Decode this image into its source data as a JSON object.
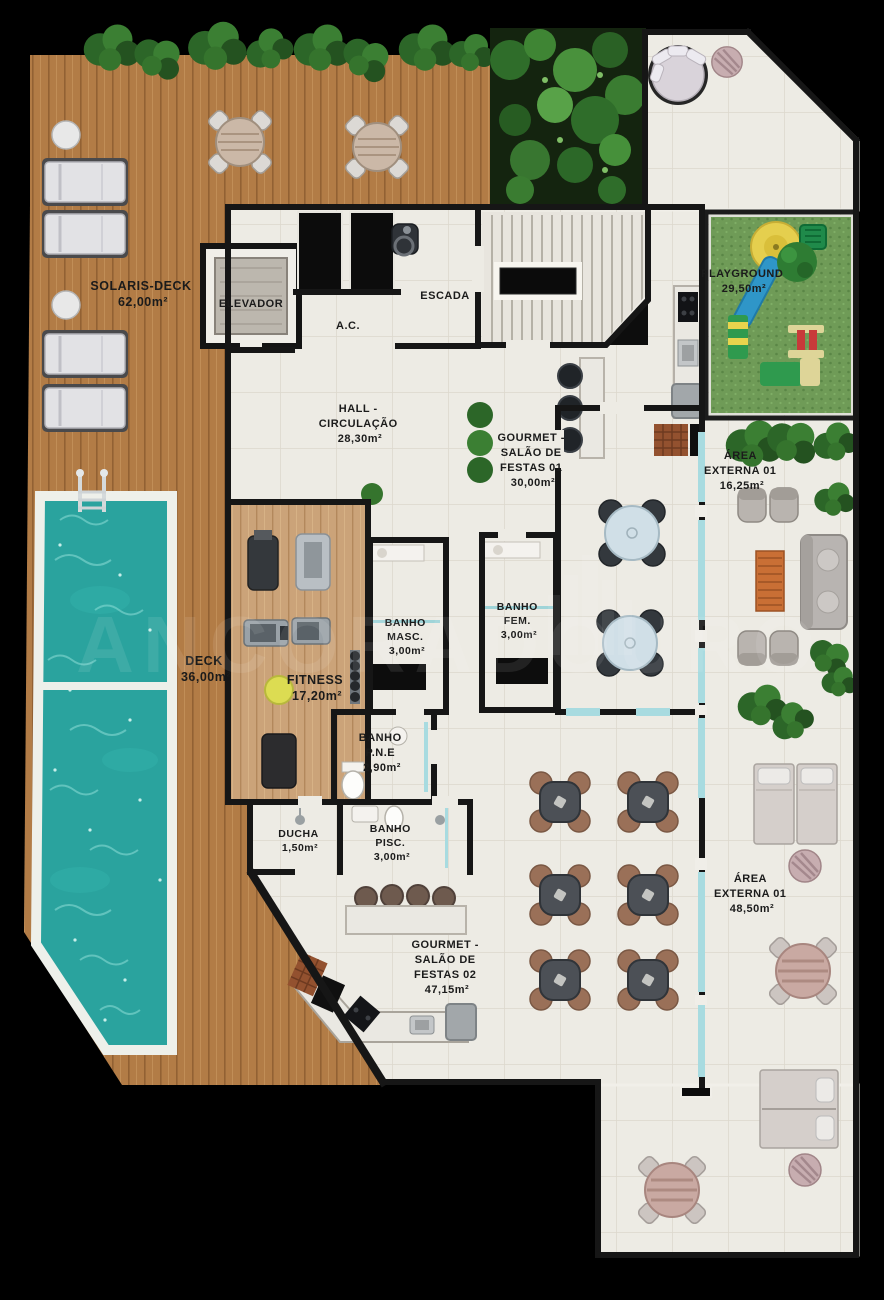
{
  "rooms": {
    "solaris_deck": {
      "name": "SOLARIS-DECK",
      "area": "62,00m²"
    },
    "elevador": {
      "name": "ELEVADOR"
    },
    "escada": {
      "name": "ESCADA"
    },
    "ac": {
      "name": "A.C."
    },
    "hall": {
      "l1": "HALL -",
      "l2": "CIRCULAÇÃO",
      "area": "28,30m²"
    },
    "gourmet_01": {
      "l1": "GOURMET -",
      "l2": "SALÃO DE",
      "l3": "FESTAS 01",
      "area": "30,00m²"
    },
    "playground": {
      "name": "PLAYGROUND",
      "area": "29,50m²"
    },
    "area_externa_top": {
      "l1": "ÁREA",
      "l2": "EXTERNA 01",
      "area": "16,25m²"
    },
    "deck": {
      "name": "DECK",
      "area": "36,00m²"
    },
    "fitness": {
      "name": "FITNESS",
      "area": "17,20m²"
    },
    "banho_masc": {
      "l1": "BANHO",
      "l2": "MASC.",
      "area": "3,00m²"
    },
    "banho_fem": {
      "l1": "BANHO",
      "l2": "FEM.",
      "area": "3,00m²"
    },
    "banho_pne": {
      "l1": "BANHO",
      "l2": "P.N.E",
      "area": "2,90m²"
    },
    "ducha": {
      "name": "DUCHA",
      "area": "1,50m²"
    },
    "banho_pisc": {
      "l1": "BANHO",
      "l2": "PISC.",
      "area": "3,00m²"
    },
    "gourmet_02": {
      "l1": "GOURMET -",
      "l2": "SALÃO DE",
      "l3": "FESTAS 02",
      "area": "47,15m²"
    },
    "area_externa_right": {
      "l1": "ÁREA",
      "l2": "EXTERNA 01",
      "area": "48,50m²"
    }
  },
  "watermark": {
    "text": "ANCORADOURO"
  },
  "colors": {
    "pool_water": "#2aa39e",
    "deck_wood": "#b27c46",
    "floor_tile": "#edebe4",
    "grass": "#6f9b57",
    "wall": "#161616",
    "glass": "#a8dbe0",
    "plants": "#2f6d2a"
  }
}
